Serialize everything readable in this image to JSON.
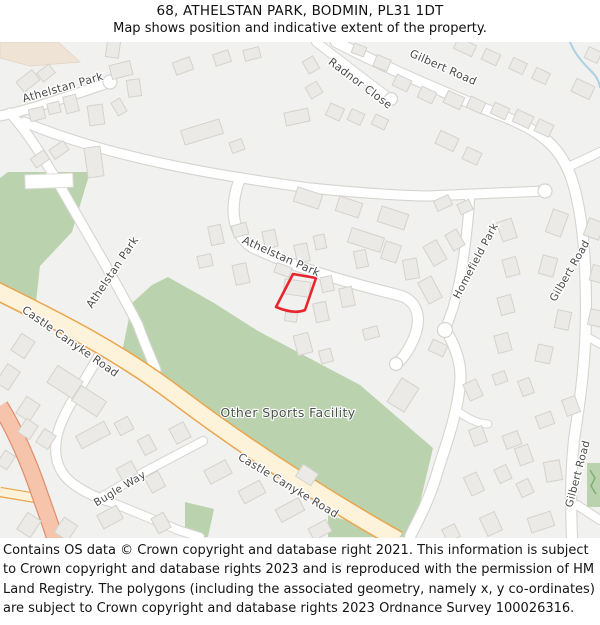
{
  "header": {
    "title": "68, ATHELSTAN PARK, BODMIN, PL31 1DT",
    "subtitle": "Map shows position and indicative extent of the property."
  },
  "map": {
    "labels": {
      "athelstan_park_top": "Athelstan Park",
      "athelstan_park_left": "Athelstan Park",
      "athelstan_park_mid": "Athelstan Park",
      "radnor_close": "Radnor Close",
      "gilbert_road_top": "Gilbert Road",
      "gilbert_road_right": "Gilbert Road",
      "gilbert_road_bottom": "Gilbert Road",
      "homefield_park": "Homefield Park",
      "castle_canyke_road_upper": "Castle Canyke Road",
      "castle_canyke_road_lower": "Castle Canyke Road",
      "bugle_way": "Bugle Way",
      "other_sports_facility": "Other Sports Facility"
    },
    "colors": {
      "background": "#f1f1ef",
      "building_fill": "#eceae7",
      "building_stroke": "#d5d2cd",
      "green_area": "#bad3ae",
      "beige_area": "#efe3d5",
      "road_primary_fill": "#fcf3da",
      "road_primary_stroke": "#eca44b",
      "road_a_fill": "#f6c4ab",
      "road_a_stroke": "#df8f6e",
      "road_minor_fill": "#ffffff",
      "road_minor_stroke": "#d7d4d0",
      "water": "#a9d2e2",
      "property_outline": "#e8252c",
      "label_color": "#4a4a4a"
    }
  },
  "footer": {
    "text": "Contains OS data © Crown copyright and database right 2021. This information is subject to Crown copyright and database rights 2023 and is reproduced with the permission of HM Land Registry. The polygons (including the associated geometry, namely x, y co-ordinates) are subject to Crown copyright and database rights 2023 Ordnance Survey 100026316."
  }
}
